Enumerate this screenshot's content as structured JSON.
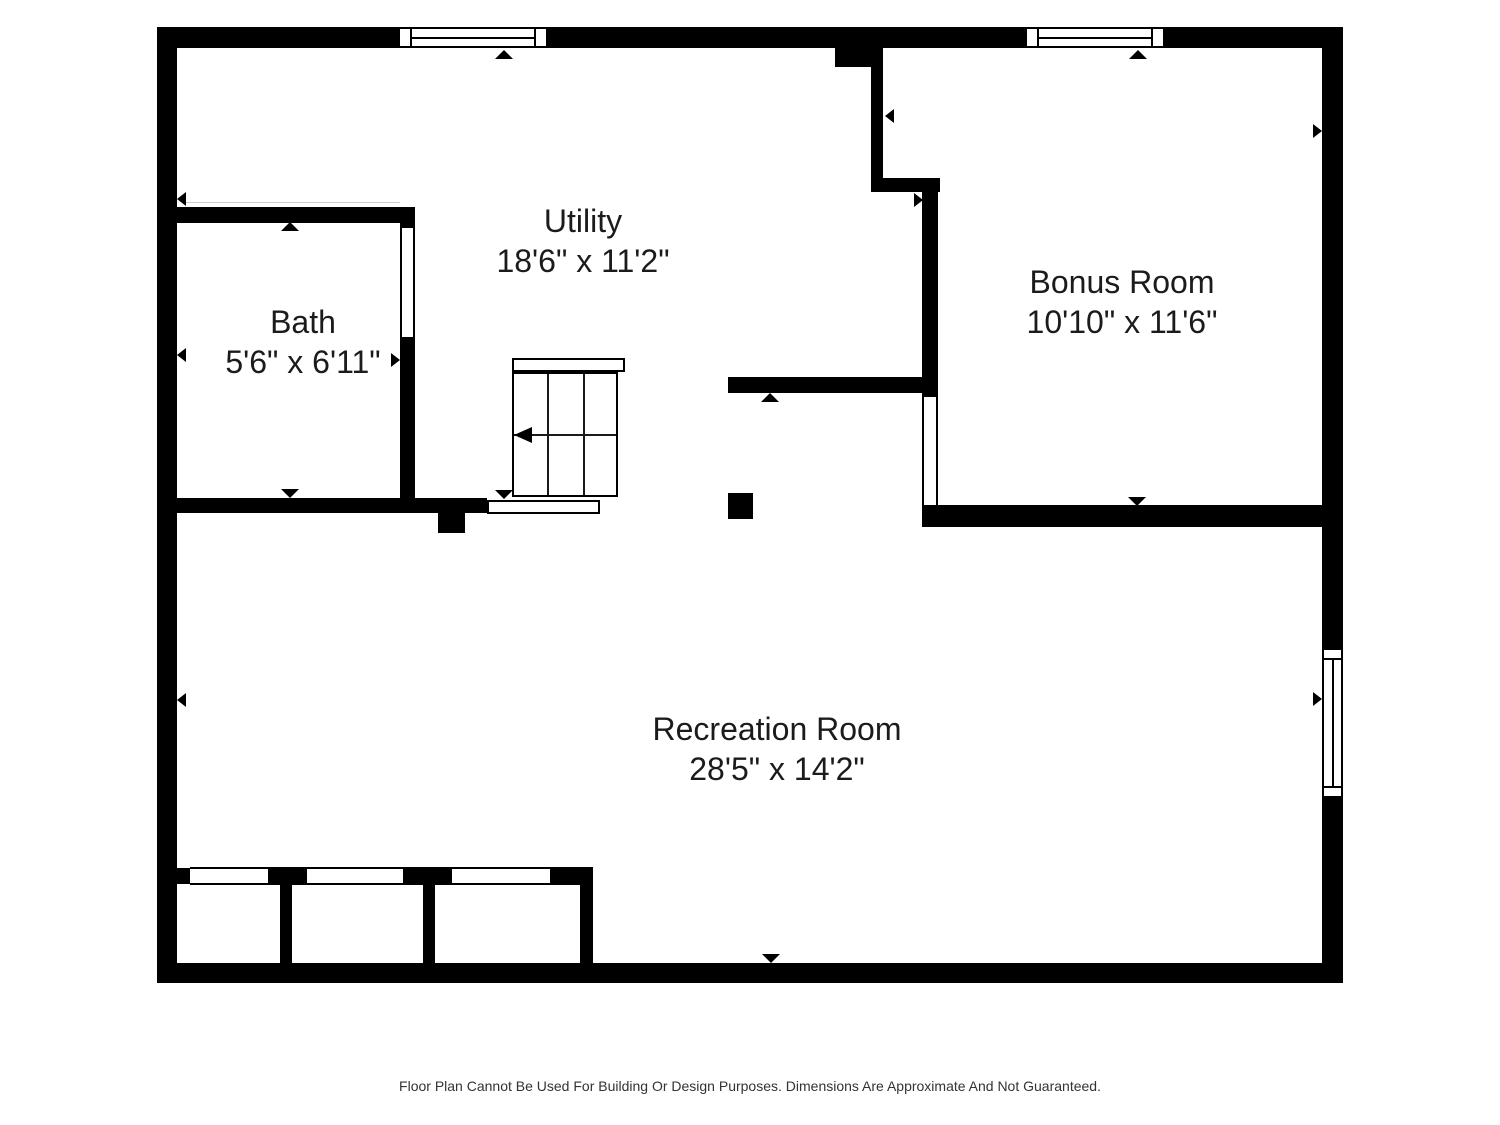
{
  "rooms": [
    {
      "id": "utility",
      "name": "Utility",
      "dimensions": "18'6\" x 11'2\""
    },
    {
      "id": "bath",
      "name": "Bath",
      "dimensions": "5'6\" x 6'11\""
    },
    {
      "id": "bonus",
      "name": "Bonus Room",
      "dimensions": "10'10\" x 11'6\""
    },
    {
      "id": "recreation",
      "name": "Recreation Room",
      "dimensions": "28'5\" x 14'2\""
    }
  ],
  "footer": {
    "disclaimer": "Floor Plan Cannot Be Used For Building Or Design Purposes. Dimensions Are Approximate And Not Guaranteed."
  },
  "colors": {
    "wall": "#000000",
    "background": "#ffffff",
    "label_text": "#1b1b1b",
    "footer_text": "#333333"
  }
}
